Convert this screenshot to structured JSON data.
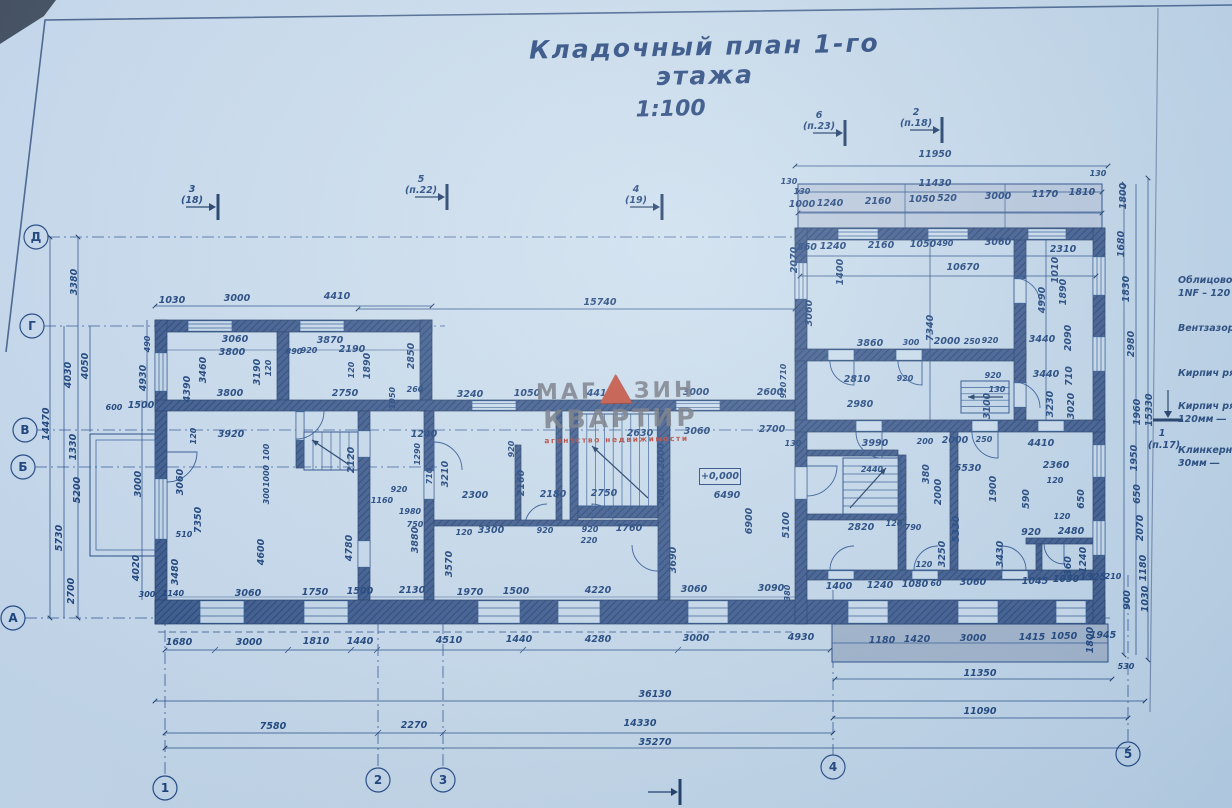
{
  "title": {
    "text": "Кладочный план 1-го этажа",
    "scale": "1:100"
  },
  "watermark": {
    "part1": "МАГ",
    "part2": "ЗИН",
    "line2": "КВАРТИР",
    "line3": "агентство  недвижимости",
    "triangle_icon": "red-triangle"
  },
  "elevation_mark": "+0,000",
  "colors": {
    "ink": "#1d4380",
    "wall_fill": "#35548a",
    "paper": "#cadded",
    "watermark_red": "#c04835",
    "watermark_gray": "#686d78"
  },
  "axes": {
    "bottom": [
      {
        "label": "1",
        "x": 165,
        "cy": 788,
        "to": 608
      },
      {
        "label": "2",
        "x": 378,
        "cy": 780,
        "to": 600
      },
      {
        "label": "3",
        "x": 443,
        "cy": 780,
        "to": 600
      },
      {
        "label": "4",
        "x": 833,
        "cy": 767,
        "to": 590
      },
      {
        "label": "5",
        "x": 1128,
        "cy": 754,
        "to": 575
      }
    ],
    "left": [
      {
        "label": "Д",
        "cx": 36,
        "y": 237,
        "to": 1105
      },
      {
        "label": "Г",
        "cx": 32,
        "y": 326,
        "to": 445
      },
      {
        "label": "В",
        "cx": 25,
        "y": 430,
        "to": 1105
      },
      {
        "label": "Б",
        "cx": 23,
        "y": 467,
        "to": 437
      },
      {
        "label": "А",
        "cx": 13,
        "y": 618,
        "to": 1110
      }
    ]
  },
  "section_markers": [
    {
      "n": "3",
      "ref": "(18)",
      "x": 218,
      "y": 207,
      "dir": "r"
    },
    {
      "n": "5",
      "ref": "(п.22)",
      "x": 447,
      "y": 197,
      "dir": "r"
    },
    {
      "n": "4",
      "ref": "(19)",
      "x": 662,
      "y": 207,
      "dir": "r"
    },
    {
      "n": "6",
      "ref": "(п.23)",
      "x": 845,
      "y": 133,
      "dir": "r"
    },
    {
      "n": "2",
      "ref": "(п.18)",
      "x": 942,
      "y": 130,
      "dir": "r"
    },
    {
      "n": "1",
      "ref": "(п.17)",
      "x": 1168,
      "y": 420,
      "dir": "d"
    },
    {
      "n": "",
      "ref": "",
      "x": 680,
      "y": 792,
      "dir": "r"
    }
  ],
  "annotations_right": [
    {
      "lines": [
        "Облицовоч",
        "1NF – 120"
      ],
      "y": 283
    },
    {
      "lines": [
        "Вентзазор"
      ],
      "y": 331
    },
    {
      "lines": [
        "Кирпич ря"
      ],
      "y": 376
    },
    {
      "lines": [
        "Кирпич ря",
        "120мм ―"
      ],
      "y": 409
    },
    {
      "lines": [
        "Клинкерн",
        "30мм ―"
      ],
      "y": 453
    }
  ],
  "dim_labels": [
    {
      "t": "11950",
      "x": 935,
      "y": 157
    },
    {
      "t": "11430",
      "x": 935,
      "y": 186
    },
    {
      "t": "130",
      "x": 789,
      "y": 184,
      "s": 1
    },
    {
      "t": "130",
      "x": 802,
      "y": 194,
      "s": 1
    },
    {
      "t": "130",
      "x": 1098,
      "y": 176,
      "s": 1
    },
    {
      "t": "1800",
      "x": 1126,
      "y": 196,
      "r": -90
    },
    {
      "t": "1000",
      "x": 802,
      "y": 207
    },
    {
      "t": "1240",
      "x": 830,
      "y": 206
    },
    {
      "t": "2160",
      "x": 878,
      "y": 204
    },
    {
      "t": "1050",
      "x": 922,
      "y": 202
    },
    {
      "t": "520",
      "x": 947,
      "y": 201
    },
    {
      "t": "3000",
      "x": 998,
      "y": 199
    },
    {
      "t": "1170",
      "x": 1045,
      "y": 197
    },
    {
      "t": "1810",
      "x": 1082,
      "y": 195
    },
    {
      "t": "860",
      "x": 807,
      "y": 250
    },
    {
      "t": "1240",
      "x": 833,
      "y": 249
    },
    {
      "t": "2160",
      "x": 881,
      "y": 248
    },
    {
      "t": "1050",
      "x": 923,
      "y": 247
    },
    {
      "t": "490",
      "x": 945,
      "y": 246,
      "s": 1
    },
    {
      "t": "3060",
      "x": 998,
      "y": 245
    },
    {
      "t": "2310",
      "x": 1063,
      "y": 252
    },
    {
      "t": "2070",
      "x": 797,
      "y": 260,
      "r": -90
    },
    {
      "t": "1400",
      "x": 843,
      "y": 272,
      "r": -90
    },
    {
      "t": "1010",
      "x": 1058,
      "y": 270,
      "r": -90
    },
    {
      "t": "1890",
      "x": 1066,
      "y": 292,
      "r": -90
    },
    {
      "t": "1680",
      "x": 1124,
      "y": 244,
      "r": -90
    },
    {
      "t": "1830",
      "x": 1129,
      "y": 289,
      "r": -90
    },
    {
      "t": "4990",
      "x": 1045,
      "y": 300,
      "r": -90
    },
    {
      "t": "10670",
      "x": 963,
      "y": 270
    },
    {
      "t": "3060",
      "x": 812,
      "y": 313,
      "r": -90
    },
    {
      "t": "7340",
      "x": 933,
      "y": 328,
      "r": -90
    },
    {
      "t": "2090",
      "x": 1071,
      "y": 338,
      "r": -90
    },
    {
      "t": "2980",
      "x": 1134,
      "y": 344,
      "r": -90
    },
    {
      "t": "15330",
      "x": 1152,
      "y": 410,
      "r": -90
    },
    {
      "t": "1960",
      "x": 1140,
      "y": 412,
      "r": -90
    },
    {
      "t": "3860",
      "x": 870,
      "y": 346
    },
    {
      "t": "300",
      "x": 911,
      "y": 345,
      "s": 1
    },
    {
      "t": "2000",
      "x": 947,
      "y": 344
    },
    {
      "t": "250",
      "x": 972,
      "y": 344,
      "s": 1
    },
    {
      "t": "920",
      "x": 990,
      "y": 343,
      "s": 1
    },
    {
      "t": "3440",
      "x": 1042,
      "y": 342
    },
    {
      "t": "2810",
      "x": 857,
      "y": 382
    },
    {
      "t": "920",
      "x": 905,
      "y": 381,
      "s": 1
    },
    {
      "t": "920",
      "x": 993,
      "y": 378,
      "s": 1
    },
    {
      "t": "130",
      "x": 997,
      "y": 392,
      "s": 1
    },
    {
      "t": "3440",
      "x": 1046,
      "y": 377
    },
    {
      "t": "710",
      "x": 1072,
      "y": 376,
      "r": -90
    },
    {
      "t": "2980",
      "x": 860,
      "y": 407
    },
    {
      "t": "3100",
      "x": 990,
      "y": 406,
      "r": -90
    },
    {
      "t": "3230",
      "x": 1053,
      "y": 404,
      "r": -90
    },
    {
      "t": "3020",
      "x": 1074,
      "y": 406,
      "r": -90
    },
    {
      "t": "4410",
      "x": 1041,
      "y": 446
    },
    {
      "t": "3990",
      "x": 875,
      "y": 446
    },
    {
      "t": "200",
      "x": 925,
      "y": 444,
      "s": 1
    },
    {
      "t": "2000",
      "x": 955,
      "y": 443
    },
    {
      "t": "250",
      "x": 984,
      "y": 442,
      "s": 1
    },
    {
      "t": "380",
      "x": 929,
      "y": 474,
      "r": -90
    },
    {
      "t": "5530",
      "x": 968,
      "y": 471
    },
    {
      "t": "1900",
      "x": 996,
      "y": 489,
      "r": -90
    },
    {
      "t": "2000",
      "x": 941,
      "y": 492,
      "r": -90
    },
    {
      "t": "2360",
      "x": 1056,
      "y": 468
    },
    {
      "t": "120",
      "x": 1055,
      "y": 483,
      "s": 1
    },
    {
      "t": "650",
      "x": 1084,
      "y": 499,
      "r": -90
    },
    {
      "t": "590",
      "x": 1029,
      "y": 499,
      "r": -90
    },
    {
      "t": "920",
      "x": 1031,
      "y": 535
    },
    {
      "t": "2480",
      "x": 1071,
      "y": 534
    },
    {
      "t": "120",
      "x": 1062,
      "y": 519,
      "s": 1
    },
    {
      "t": "5330",
      "x": 959,
      "y": 529,
      "r": -90
    },
    {
      "t": "3250",
      "x": 945,
      "y": 554,
      "r": -90
    },
    {
      "t": "3430",
      "x": 1003,
      "y": 554,
      "r": -90
    },
    {
      "t": "2820",
      "x": 861,
      "y": 530
    },
    {
      "t": "120",
      "x": 894,
      "y": 526,
      "s": 1
    },
    {
      "t": "790",
      "x": 913,
      "y": 530,
      "s": 1
    },
    {
      "t": "2440",
      "x": 872,
      "y": 472,
      "s": 1
    },
    {
      "t": "120",
      "x": 924,
      "y": 567,
      "s": 1
    },
    {
      "t": "1400",
      "x": 839,
      "y": 589
    },
    {
      "t": "1240",
      "x": 880,
      "y": 588
    },
    {
      "t": "1080",
      "x": 915,
      "y": 587
    },
    {
      "t": "60",
      "x": 936,
      "y": 586,
      "s": 1
    },
    {
      "t": "3060",
      "x": 973,
      "y": 585
    },
    {
      "t": "1045",
      "x": 1035,
      "y": 584
    },
    {
      "t": "1050",
      "x": 1066,
      "y": 582
    },
    {
      "t": "1325",
      "x": 1093,
      "y": 580
    },
    {
      "t": "210",
      "x": 1113,
      "y": 579,
      "s": 1
    },
    {
      "t": "360",
      "x": 1071,
      "y": 566,
      "r": -90
    },
    {
      "t": "1240",
      "x": 1086,
      "y": 560,
      "r": -90
    },
    {
      "t": "1950",
      "x": 1137,
      "y": 458,
      "r": -90
    },
    {
      "t": "650",
      "x": 1140,
      "y": 494,
      "r": -90
    },
    {
      "t": "2070",
      "x": 1143,
      "y": 528,
      "r": -90
    },
    {
      "t": "1180",
      "x": 1146,
      "y": 568,
      "r": -90
    },
    {
      "t": "900",
      "x": 1130,
      "y": 600,
      "r": -90
    },
    {
      "t": "1030",
      "x": 1148,
      "y": 599,
      "r": -90
    },
    {
      "t": "1800",
      "x": 1093,
      "y": 640,
      "r": -90
    },
    {
      "t": "530",
      "x": 1126,
      "y": 669,
      "s": 1
    },
    {
      "t": "1180",
      "x": 882,
      "y": 643
    },
    {
      "t": "1420",
      "x": 917,
      "y": 642
    },
    {
      "t": "3000",
      "x": 973,
      "y": 641
    },
    {
      "t": "1415",
      "x": 1032,
      "y": 640
    },
    {
      "t": "1050",
      "x": 1064,
      "y": 639
    },
    {
      "t": "1945",
      "x": 1103,
      "y": 638
    },
    {
      "t": "11350",
      "x": 980,
      "y": 676
    },
    {
      "t": "11090",
      "x": 980,
      "y": 714
    },
    {
      "t": "15740",
      "x": 600,
      "y": 305
    },
    {
      "t": "3240",
      "x": 470,
      "y": 397
    },
    {
      "t": "1050",
      "x": 527,
      "y": 396
    },
    {
      "t": "4410",
      "x": 600,
      "y": 396
    },
    {
      "t": "3000",
      "x": 696,
      "y": 395
    },
    {
      "t": "2600",
      "x": 770,
      "y": 395
    },
    {
      "t": "920",
      "x": 786,
      "y": 390,
      "r": -90,
      "s": 1
    },
    {
      "t": "710",
      "x": 786,
      "y": 372,
      "r": -90,
      "s": 1
    },
    {
      "t": "1240",
      "x": 424,
      "y": 437
    },
    {
      "t": "2630",
      "x": 640,
      "y": 436
    },
    {
      "t": "3060",
      "x": 697,
      "y": 434
    },
    {
      "t": "2700",
      "x": 772,
      "y": 432
    },
    {
      "t": "130",
      "x": 793,
      "y": 446,
      "s": 1
    },
    {
      "t": "920",
      "x": 514,
      "y": 449,
      "r": -90,
      "s": 1
    },
    {
      "t": "2000",
      "x": 664,
      "y": 456,
      "r": -90
    },
    {
      "t": "1010",
      "x": 664,
      "y": 482,
      "r": -90,
      "s": 1
    },
    {
      "t": "200",
      "x": 664,
      "y": 498,
      "r": -90,
      "s": 1
    },
    {
      "t": "2300",
      "x": 475,
      "y": 498
    },
    {
      "t": "3210",
      "x": 448,
      "y": 474,
      "r": -90
    },
    {
      "t": "2160",
      "x": 524,
      "y": 483,
      "r": -90
    },
    {
      "t": "2180",
      "x": 553,
      "y": 497
    },
    {
      "t": "2750",
      "x": 604,
      "y": 496
    },
    {
      "t": "6490",
      "x": 727,
      "y": 498
    },
    {
      "t": "6900",
      "x": 752,
      "y": 521,
      "r": -90
    },
    {
      "t": "5100",
      "x": 789,
      "y": 525,
      "r": -90
    },
    {
      "t": "1290",
      "x": 420,
      "y": 454,
      "r": -90,
      "s": 1
    },
    {
      "t": "710",
      "x": 432,
      "y": 476,
      "r": -90,
      "s": 1
    },
    {
      "t": "3300",
      "x": 491,
      "y": 533
    },
    {
      "t": "120",
      "x": 464,
      "y": 535,
      "s": 1
    },
    {
      "t": "920",
      "x": 545,
      "y": 533,
      "s": 1
    },
    {
      "t": "920",
      "x": 590,
      "y": 532,
      "s": 1
    },
    {
      "t": "220",
      "x": 589,
      "y": 543,
      "s": 1
    },
    {
      "t": "1760",
      "x": 629,
      "y": 531
    },
    {
      "t": "3570",
      "x": 452,
      "y": 564,
      "r": -90
    },
    {
      "t": "3690",
      "x": 676,
      "y": 560,
      "r": -90
    },
    {
      "t": "1970",
      "x": 470,
      "y": 595
    },
    {
      "t": "1500",
      "x": 516,
      "y": 594
    },
    {
      "t": "4220",
      "x": 598,
      "y": 593
    },
    {
      "t": "3060",
      "x": 694,
      "y": 592
    },
    {
      "t": "3090",
      "x": 771,
      "y": 591
    },
    {
      "t": "380",
      "x": 790,
      "y": 593,
      "r": -90,
      "s": 1
    },
    {
      "t": "1030",
      "x": 172,
      "y": 303
    },
    {
      "t": "3000",
      "x": 237,
      "y": 301
    },
    {
      "t": "4410",
      "x": 337,
      "y": 299
    },
    {
      "t": "490",
      "x": 150,
      "y": 344,
      "r": -90,
      "s": 1
    },
    {
      "t": "3060",
      "x": 235,
      "y": 342
    },
    {
      "t": "3800",
      "x": 232,
      "y": 355
    },
    {
      "t": "3870",
      "x": 330,
      "y": 343
    },
    {
      "t": "890",
      "x": 294,
      "y": 354,
      "s": 1
    },
    {
      "t": "920",
      "x": 309,
      "y": 353,
      "s": 1
    },
    {
      "t": "2190",
      "x": 352,
      "y": 352
    },
    {
      "t": "3460",
      "x": 206,
      "y": 370,
      "r": -90
    },
    {
      "t": "120",
      "x": 271,
      "y": 368,
      "r": -90,
      "s": 1
    },
    {
      "t": "120",
      "x": 354,
      "y": 370,
      "r": -90,
      "s": 1
    },
    {
      "t": "1890",
      "x": 370,
      "y": 366,
      "r": -90
    },
    {
      "t": "2850",
      "x": 414,
      "y": 356,
      "r": -90
    },
    {
      "t": "3190",
      "x": 260,
      "y": 372,
      "r": -90
    },
    {
      "t": "4390",
      "x": 190,
      "y": 389,
      "r": -90
    },
    {
      "t": "4930",
      "x": 146,
      "y": 378,
      "r": -90
    },
    {
      "t": "260",
      "x": 415,
      "y": 392,
      "s": 1
    },
    {
      "t": "1050",
      "x": 395,
      "y": 398,
      "r": -90,
      "s": 1
    },
    {
      "t": "3800",
      "x": 230,
      "y": 396
    },
    {
      "t": "2750",
      "x": 345,
      "y": 396
    },
    {
      "t": "3920",
      "x": 231,
      "y": 437
    },
    {
      "t": "120",
      "x": 196,
      "y": 436,
      "r": -90,
      "s": 1
    },
    {
      "t": "100",
      "x": 269,
      "y": 452,
      "r": -90,
      "s": 1
    },
    {
      "t": "1000",
      "x": 269,
      "y": 476,
      "r": -90,
      "s": 1
    },
    {
      "t": "300",
      "x": 269,
      "y": 496,
      "r": -90,
      "s": 1
    },
    {
      "t": "2120",
      "x": 354,
      "y": 460,
      "r": -90
    },
    {
      "t": "920",
      "x": 399,
      "y": 492,
      "s": 1
    },
    {
      "t": "1160",
      "x": 382,
      "y": 503,
      "s": 1
    },
    {
      "t": "1980",
      "x": 410,
      "y": 514,
      "s": 1
    },
    {
      "t": "750",
      "x": 415,
      "y": 527,
      "s": 1
    },
    {
      "t": "510",
      "x": 184,
      "y": 537,
      "s": 1
    },
    {
      "t": "3060",
      "x": 183,
      "y": 482,
      "r": -90
    },
    {
      "t": "7350",
      "x": 201,
      "y": 520,
      "r": -90
    },
    {
      "t": "3480",
      "x": 178,
      "y": 572,
      "r": -90
    },
    {
      "t": "4600",
      "x": 264,
      "y": 552,
      "r": -90
    },
    {
      "t": "4780",
      "x": 352,
      "y": 548,
      "r": -90
    },
    {
      "t": "3880",
      "x": 418,
      "y": 540,
      "r": -90
    },
    {
      "t": "3060",
      "x": 248,
      "y": 596
    },
    {
      "t": "1750",
      "x": 315,
      "y": 595
    },
    {
      "t": "1500",
      "x": 360,
      "y": 594
    },
    {
      "t": "2130",
      "x": 412,
      "y": 593
    },
    {
      "t": "300",
      "x": 147,
      "y": 597,
      "s": 1
    },
    {
      "t": "1140",
      "x": 173,
      "y": 596,
      "s": 1
    },
    {
      "t": "1680",
      "x": 179,
      "y": 645
    },
    {
      "t": "3000",
      "x": 249,
      "y": 645
    },
    {
      "t": "1810",
      "x": 316,
      "y": 644
    },
    {
      "t": "1440",
      "x": 360,
      "y": 644
    },
    {
      "t": "4510",
      "x": 449,
      "y": 643
    },
    {
      "t": "1440",
      "x": 519,
      "y": 642
    },
    {
      "t": "4280",
      "x": 598,
      "y": 642
    },
    {
      "t": "3000",
      "x": 696,
      "y": 641
    },
    {
      "t": "4930",
      "x": 801,
      "y": 640
    },
    {
      "t": "36130",
      "x": 655,
      "y": 697
    },
    {
      "t": "7580",
      "x": 273,
      "y": 729
    },
    {
      "t": "2270",
      "x": 414,
      "y": 728
    },
    {
      "t": "14330",
      "x": 640,
      "y": 726
    },
    {
      "t": "35270",
      "x": 655,
      "y": 745
    },
    {
      "t": "3380",
      "x": 77,
      "y": 282,
      "r": -90
    },
    {
      "t": "4050",
      "x": 88,
      "y": 366,
      "r": -90
    },
    {
      "t": "4030",
      "x": 71,
      "y": 375,
      "r": -90
    },
    {
      "t": "14470",
      "x": 49,
      "y": 424,
      "r": -90
    },
    {
      "t": "1330",
      "x": 76,
      "y": 447,
      "r": -90
    },
    {
      "t": "5200",
      "x": 80,
      "y": 490,
      "r": -90
    },
    {
      "t": "5730",
      "x": 62,
      "y": 538,
      "r": -90
    },
    {
      "t": "2700",
      "x": 74,
      "y": 591,
      "r": -90
    },
    {
      "t": "600",
      "x": 114,
      "y": 410,
      "s": 1
    },
    {
      "t": "1500",
      "x": 141,
      "y": 408
    },
    {
      "t": "3000",
      "x": 141,
      "y": 484,
      "r": -90
    },
    {
      "t": "4020",
      "x": 139,
      "y": 568,
      "r": -90
    }
  ]
}
